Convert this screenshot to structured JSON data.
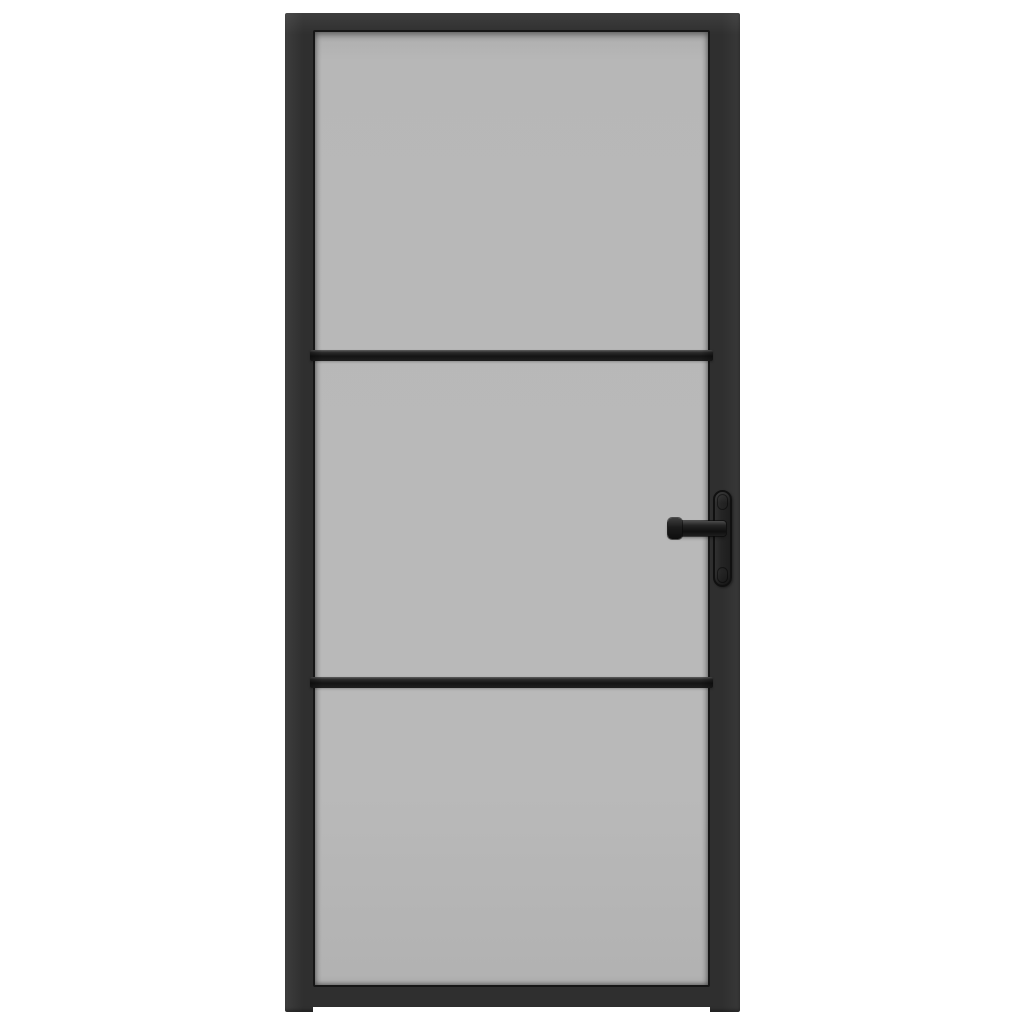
{
  "image": {
    "kind": "product-photo",
    "subject": "interior door with black frame and frosted glass",
    "background": "plain white, no text or watermark"
  },
  "door": {
    "glass_panels": 3,
    "divider_bars": 2,
    "handle": {
      "side": "right",
      "parts": [
        "backplate",
        "lever"
      ]
    },
    "colors": {
      "background": "#ffffff",
      "frame": "#2f2f2f",
      "frame_highlight": "#3d3d3d",
      "frame_shadow": "#161616",
      "glass": "#b9b9b9",
      "divider_bar": "#141414",
      "handle": "#1e1e1e"
    }
  }
}
